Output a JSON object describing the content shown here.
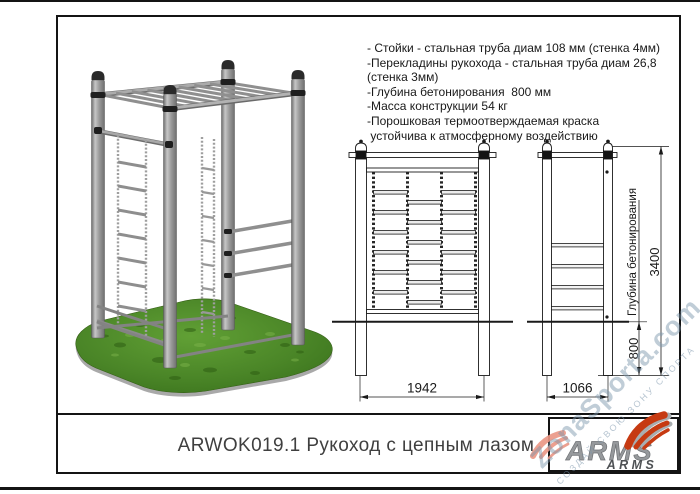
{
  "title_bar": {
    "text": "ARWOK019.1 Рукоход с цепным лазом"
  },
  "specs": {
    "lines": [
      "- Стойки - стальная труба диам 108 мм (стенка 4мм)",
      "-Перекладины рукохода - стальная труба диам 26,8",
      "(стенка 3мм)",
      "-Глубина бетонирования  800 мм",
      "-Масса конструкции 54 кг",
      "-Порошковая термоотверждаемая краска",
      " устойчива к атмосферному воздействию"
    ]
  },
  "drawings": {
    "front_view": {
      "width_label": "1942"
    },
    "side_view": {
      "width_label": "1066",
      "height_label": "3400",
      "foundation_depth_label": "800",
      "foundation_text": "Глубина бетонирования"
    }
  },
  "logo": {
    "brand": "ARMS",
    "brand_small": "ARMS",
    "accent_color": "#c63a12",
    "metal_color": "#96999c"
  },
  "watermark": {
    "site": "ZonaSporta.com",
    "slogan": "СОЗДАЙ СВОЮ ЗОНУ СПОРТА"
  },
  "colors": {
    "line": "#1a1a1a",
    "grass_green": "#4a8527",
    "post_gray": "#9a9a9a",
    "watermark_blue": "#7c96ac"
  }
}
